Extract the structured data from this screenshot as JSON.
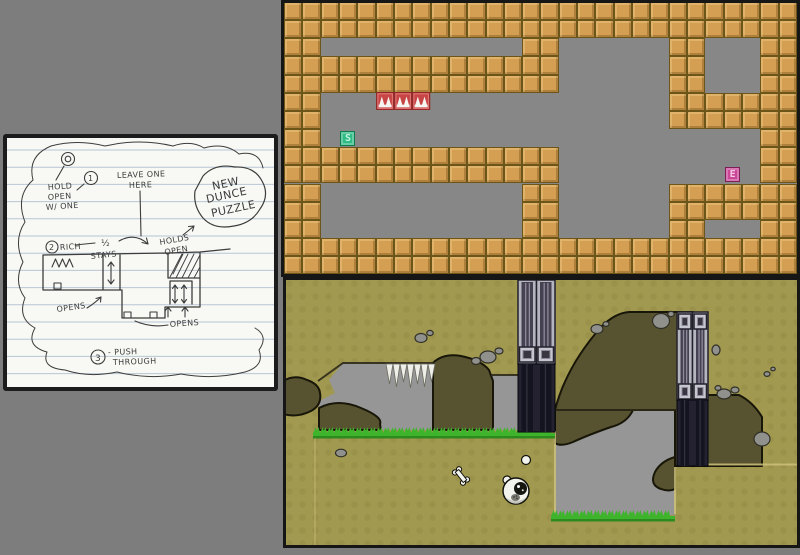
{
  "scene": {
    "background": "#7d7d7d"
  },
  "sketch": {
    "paper_color": "#f8f8f5",
    "frame_color": "#1c1c1c",
    "rule_line_color": "#b8c6d4",
    "pencil_color": "#3c3c3c",
    "rule_spacing": 17.2,
    "rule_start_y": 12,
    "annotations": [
      {
        "text": "HOLD",
        "x": 41,
        "y": 52,
        "s": 8,
        "r": -4
      },
      {
        "text": "OPEN",
        "x": 41,
        "y": 62,
        "s": 8,
        "r": -4
      },
      {
        "text": "W/ ONE",
        "x": 39,
        "y": 72,
        "s": 8,
        "r": -4
      },
      {
        "text": "LEAVE ONE",
        "x": 110,
        "y": 40,
        "s": 8,
        "r": -2
      },
      {
        "text": "HERE",
        "x": 122,
        "y": 50,
        "s": 8,
        "r": -2
      },
      {
        "text": "NEW",
        "x": 206,
        "y": 52,
        "s": 11,
        "r": -12
      },
      {
        "text": "DUNCE",
        "x": 200,
        "y": 65,
        "s": 11,
        "r": -12
      },
      {
        "text": "PUZZLE",
        "x": 205,
        "y": 79,
        "s": 11,
        "r": -12
      },
      {
        "text": "RICH",
        "x": 53,
        "y": 112,
        "s": 8,
        "r": -3
      },
      {
        "text": "½",
        "x": 94,
        "y": 108,
        "s": 9,
        "r": 0
      },
      {
        "text": "STAYS",
        "x": 84,
        "y": 121,
        "s": 8,
        "r": -6
      },
      {
        "text": "HOLDS",
        "x": 153,
        "y": 107,
        "s": 8,
        "r": -10
      },
      {
        "text": "OPEN",
        "x": 158,
        "y": 117,
        "s": 8,
        "r": -10
      },
      {
        "text": "OPENS",
        "x": 50,
        "y": 174,
        "s": 8,
        "r": -8
      },
      {
        "text": "OPENS",
        "x": 163,
        "y": 189,
        "s": 8,
        "r": -4
      },
      {
        "text": "- PUSH",
        "x": 101,
        "y": 217,
        "s": 8,
        "r": -2
      },
      {
        "text": "THROUGH",
        "x": 106,
        "y": 227,
        "s": 8,
        "r": -2
      },
      {
        "text": "1",
        "x": 81,
        "y": 43,
        "s": 8,
        "r": 0
      },
      {
        "text": "2",
        "x": 42,
        "y": 112,
        "s": 8,
        "r": 0
      },
      {
        "text": "3",
        "x": 88,
        "y": 223,
        "s": 9,
        "r": 0
      }
    ],
    "circles": [
      {
        "cx": 61,
        "cy": 21,
        "r": 6.5
      },
      {
        "cx": 61,
        "cy": 21,
        "r": 2.8
      },
      {
        "cx": 84,
        "cy": 40,
        "r": 6.5
      },
      {
        "cx": 45,
        "cy": 109,
        "r": 6
      },
      {
        "cx": 91,
        "cy": 219,
        "r": 7
      }
    ],
    "paths": [
      {
        "d": "M57,28 L49,42",
        "w": 1.1
      },
      {
        "d": "M77,46 L70,52",
        "w": 1.1
      },
      {
        "d": "M133,53 L134,98",
        "w": 1.1
      },
      {
        "d": "M196,38 Q208,25 228,29 Q247,28 255,43 Q263,57 253,71 Q245,85 227,88 Q207,92 196,80 Q186,68 188,53 Z",
        "w": 1.2
      },
      {
        "d": "M176,97 L187,88 M187,88 l-5.5,0.5 M187,88 l-1.5,5",
        "w": 1.1
      },
      {
        "d": "M68,107 L88,105",
        "w": 1.1
      },
      {
        "d": "M112,103 Q128,94 141,106 M141,106 l-6,-1.5 M141,106 l-1.5,-6",
        "w": 1.1
      },
      {
        "d": "M36,117 L161,115 L193,114 L223,111 M36,117 L36,152 L115,152 L115,180 L158,180 L158,169 L193,169 L193,114 M96,117 L96,152 M113,117 L113,152 M161,115 L161,140 M161,140 L193,140 M163,143 L185,143 L185,166 M163,143 L163,166",
        "w": 1.3
      },
      {
        "d": "M104,124 L104,146 M104,124 l-3,4 M104,124 l3,4 M104,146 l-3,-4 M104,146 l3,-4",
        "w": 1.1
      },
      {
        "d": "M168,147 L168,165 M168,147 l-2.5,3.5 M168,147 l2.5,3.5 M168,165 l-2.5,-3.5 M168,165 l2.5,-3.5 M177,147 L177,165 M177,147 l-2.5,3.5 M177,147 l2.5,3.5 M177,165 l-2.5,-3.5 M177,165 l2.5,-3.5",
        "w": 1.1
      },
      {
        "d": "M45,129 l3.5,-8 l3.5,8 l3.5,-8 l3.5,8 l3.5,-8 l3.5,8",
        "w": 1.1
      },
      {
        "d": "M47,145 h7 v6 h-7 Z M117,174 h7 v6 h-7 Z M143,174 h7 v6 h-7 Z",
        "w": 1.1
      },
      {
        "d": "M163,139 L175,116 M169,140 L181,116 M175,140 L187,116 M181,140 L193,117 M187,140 L193,129 M166,136 L176,116",
        "w": 0.9
      },
      {
        "d": "M80,170 Q88,165 94,159 M94,159 l-5,1.5 M94,159 l-0.5,5",
        "w": 1.1
      },
      {
        "d": "M161,179 L161,169 M161,169 l-3,4 M161,169 l3,4 M178,179 L178,169 M178,169 l-3,4 M178,169 l3,4",
        "w": 1.1
      },
      {
        "d": "M128,183 Q144,190 161,187",
        "w": 1.1
      },
      {
        "d": "M44,8 Q70,1 98,8 Q132,0 166,8 Q184,2 197,10",
        "w": 1.0
      },
      {
        "d": "M44,8 Q20,18 26,42 Q8,58 18,84 Q6,102 16,124 Q6,144 18,160 Q10,180 28,190 Q18,208 40,214 Q34,230 58,232 Q82,240 110,234 Q142,242 174,236 Q206,242 238,234 Q258,228 252,212 Q262,198 248,190",
        "w": 1.0
      },
      {
        "d": "M197,10 Q218,4 232,16 Q252,12 256,30",
        "w": 1.0
      }
    ]
  },
  "top_level": {
    "palette": {
      "background": "#878787",
      "tile": "#d49f52",
      "tile_border": "#6b5518",
      "frame": "#161616",
      "spike_block": "#c84545",
      "spike_border": "#8e2424",
      "spike_inner": "#e07a7a",
      "spike_white": "#f5f5f2",
      "start_bg": "#2fbb84",
      "start_border": "#0e7a4e",
      "start_text": "#c8f3e2",
      "exit_bg": "#cb4697",
      "exit_border": "#7c1f58",
      "exit_text": "#f6c7e5"
    },
    "markers": {
      "start_label": "S",
      "exit_label": "E"
    },
    "legend": {
      "#": "wall tile",
      ".": "empty",
      "^": "spike block",
      "S": "start marker",
      "E": "exit marker"
    },
    "tile_w": 18.32,
    "tile_h": 18.15,
    "tile_map": [
      "############################",
      "############################",
      "##...........##......##...##",
      "###############......##...##",
      "###############......##...##",
      "##...^^^.............#######",
      "##...................#######",
      "##.S......................##",
      "###############...........##",
      "###############.........E.##",
      "##...........##......#######",
      "##...........##......#######",
      "##...........##......##...##",
      "############################",
      "############################"
    ]
  },
  "bottom_level": {
    "palette": {
      "background": "#a29950",
      "terrain": "#57522f",
      "terrain_stroke": "#181608",
      "cave": "#969696",
      "grass": "#3db42c",
      "grass_dark": "#2c8a1e",
      "edge_tan": "#cdc07a",
      "edge_dark": "#2c2918",
      "pillar_light": "#b5b5c0",
      "pillar_inner": "#454150",
      "pillar_line": "#8e8a9c",
      "emblem_plate": "#c6c6ce",
      "emblem_core": "#39363f",
      "pillar_dark": "#242231",
      "pillar_dark_inner": "#141320",
      "spike_white": "#efefe9",
      "rock": "#90908c",
      "rock_stroke": "#303028",
      "creature": "#f3f3ee",
      "outline": "#12120c"
    },
    "caves": [
      "M46,103 L60,86 L152,86 L152,153 L36,153 L36,124 L52,116 Z",
      "M208,98 L272,98 L272,153 L210,153 L210,106 Z",
      "M272,133 L392,133 L392,238 L272,238 Z"
    ],
    "terrain": [
      "M0,104 Q12,97 24,103 Q36,107 37,116 Q39,128 28,134 Q14,141 0,137 Z",
      "M36,131 Q55,121 78,131 Q100,140 97,147 L98,153 L36,153 Z",
      "M150,86 Q160,76 178,79 Q198,83 206,93 L210,104 L210,153 L150,153 Z",
      "M272,133 Q283,90 318,50 Q332,36 346,35 L410,35 L410,189 L392,189 L392,133 Z",
      "M410,118 L456,118 Q470,125 479,140 L479,189 L410,189 Z",
      "M272,133 L350,133 Q344,146 328,150 Q305,158 290,165 Q278,170 272,166 Z",
      "M392,180 Q378,184 372,195 Q366,208 378,212 Q386,215 392,212 Z"
    ],
    "edges": [
      {
        "d": "M35,104 L60,86 L152,86",
        "c": "#2c2918",
        "w": 2,
        "o": 0.9
      },
      {
        "d": "M208,98 L235,98",
        "c": "#2c2918",
        "w": 2,
        "o": 0.9
      },
      {
        "d": "M272,133 L392,133",
        "c": "#2c2918",
        "w": 2,
        "o": 0.9
      },
      {
        "d": "M272,154 L272,237",
        "c": "#cdc07a",
        "w": 2,
        "o": 0.85
      },
      {
        "d": "M392,190 L392,237",
        "c": "#cdc07a",
        "w": 2,
        "o": 0.85
      },
      {
        "d": "M425,187.5 L516,187.5",
        "c": "#cdc07a",
        "w": 2,
        "o": 0.85
      },
      {
        "d": "M32,161 L32,270",
        "c": "#cdc07a",
        "w": 1.5,
        "o": 0.55
      }
    ],
    "spike_row": {
      "x": 103,
      "y": 87,
      "count": 7,
      "w": 7,
      "heights": [
        20,
        23,
        18,
        24,
        20,
        23,
        18
      ]
    },
    "grass": [
      {
        "x": 30,
        "y": 150,
        "w": 242
      },
      {
        "x": 268,
        "y": 233,
        "w": 124
      }
    ],
    "pillars": [
      {
        "x": 235,
        "y": 3,
        "w": 37,
        "light_h": 84,
        "dark_h": 68,
        "emblems": [
          67
        ]
      },
      {
        "x": 394,
        "y": 35,
        "w": 31,
        "light_h": 88,
        "dark_h": 66,
        "emblems": [
          2,
          72
        ]
      }
    ],
    "rocks": [
      {
        "cx": 138,
        "cy": 61,
        "rx": 6,
        "ry": 4.5
      },
      {
        "cx": 147,
        "cy": 56,
        "rx": 3.2,
        "ry": 2.6
      },
      {
        "cx": 205,
        "cy": 80,
        "rx": 8,
        "ry": 6
      },
      {
        "cx": 193,
        "cy": 84,
        "rx": 4.5,
        "ry": 3.5
      },
      {
        "cx": 216,
        "cy": 74,
        "rx": 4,
        "ry": 3
      },
      {
        "cx": 314,
        "cy": 52,
        "rx": 6,
        "ry": 4.5
      },
      {
        "cx": 323,
        "cy": 47,
        "rx": 3,
        "ry": 2.4
      },
      {
        "cx": 378,
        "cy": 44,
        "rx": 8.5,
        "ry": 7.5
      },
      {
        "cx": 388,
        "cy": 37,
        "rx": 3.2,
        "ry": 2.6
      },
      {
        "cx": 433,
        "cy": 73,
        "rx": 4,
        "ry": 5
      },
      {
        "cx": 441,
        "cy": 117,
        "rx": 7,
        "ry": 5
      },
      {
        "cx": 452,
        "cy": 113,
        "rx": 4,
        "ry": 3
      },
      {
        "cx": 435,
        "cy": 111,
        "rx": 3,
        "ry": 2.4
      },
      {
        "cx": 484,
        "cy": 97,
        "rx": 3,
        "ry": 2.4
      },
      {
        "cx": 490,
        "cy": 92,
        "rx": 2.2,
        "ry": 1.8
      },
      {
        "cx": 479,
        "cy": 162,
        "rx": 8,
        "ry": 7
      },
      {
        "cx": 58,
        "cy": 176,
        "rx": 5.5,
        "ry": 3.8
      }
    ],
    "character": {
      "x": 233,
      "y": 214
    },
    "ball": {
      "x": 243,
      "y": 183
    },
    "bone": {
      "x": 178,
      "y": 199,
      "rot": -38
    }
  }
}
